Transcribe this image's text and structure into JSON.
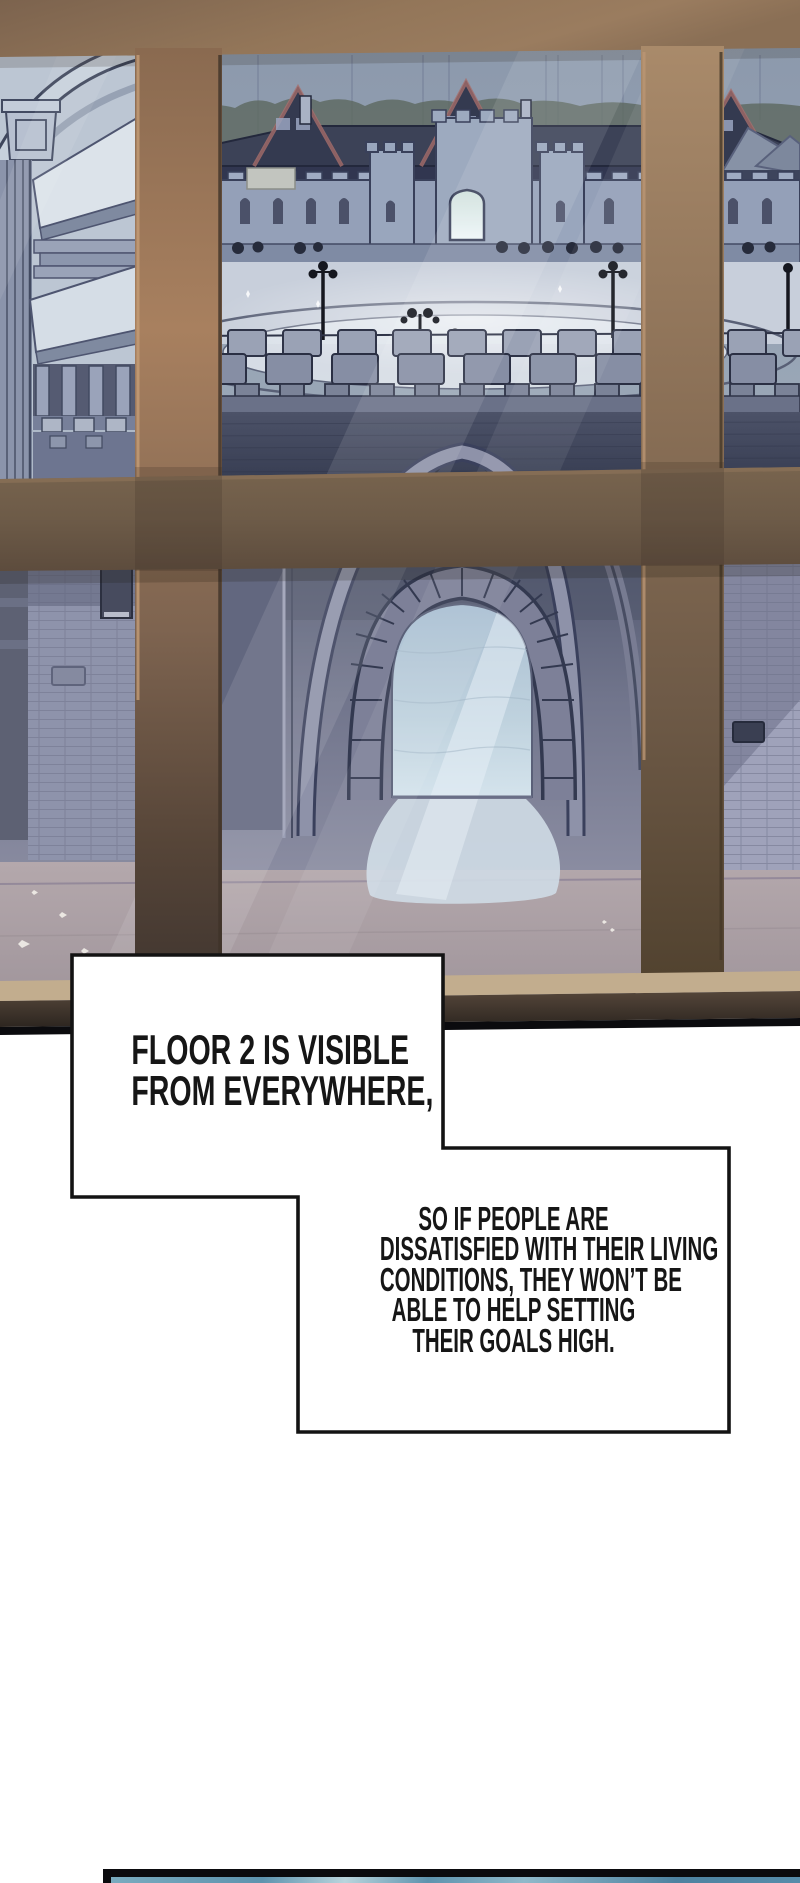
{
  "bubbles": {
    "b1": {
      "lines": [
        "FLOOR 2 IS VISIBLE",
        "FROM EVERYWHERE,"
      ]
    },
    "b2": {
      "lines": [
        "SO IF PEOPLE ARE",
        "DISSATISFIED WITH THEIR LIVING",
        "CONDITIONS, THEY WON’T BE",
        "ABLE TO HELP SETTING",
        "THEIR GOALS HIGH."
      ]
    }
  },
  "colors": {
    "page_bg": "#ffffff",
    "ink": "#161616",
    "bubble_bg": "#ffffff",
    "bubble_border": "#131313",
    "line_black": "#0b0b0e",
    "frame_light": "#a8805f",
    "frame_mid": "#75624e",
    "frame_dark": "#4a3c30",
    "sill_tan": "#c2ad8e",
    "sky": "#8f9cae",
    "stone_wall": "#94a0b8",
    "house_dark": "#2d3247",
    "roof_trim_red": "#a76f6d",
    "plaza_light": "#c8cfdb",
    "lower_wall": "#82859c",
    "brick_wall": "#9fa2ba",
    "floor_pink": "#b2a6aa",
    "arch_glow": "#cfe0ea",
    "gate_glow": "#eef6f8",
    "panel_blue": "#5d93ae"
  }
}
